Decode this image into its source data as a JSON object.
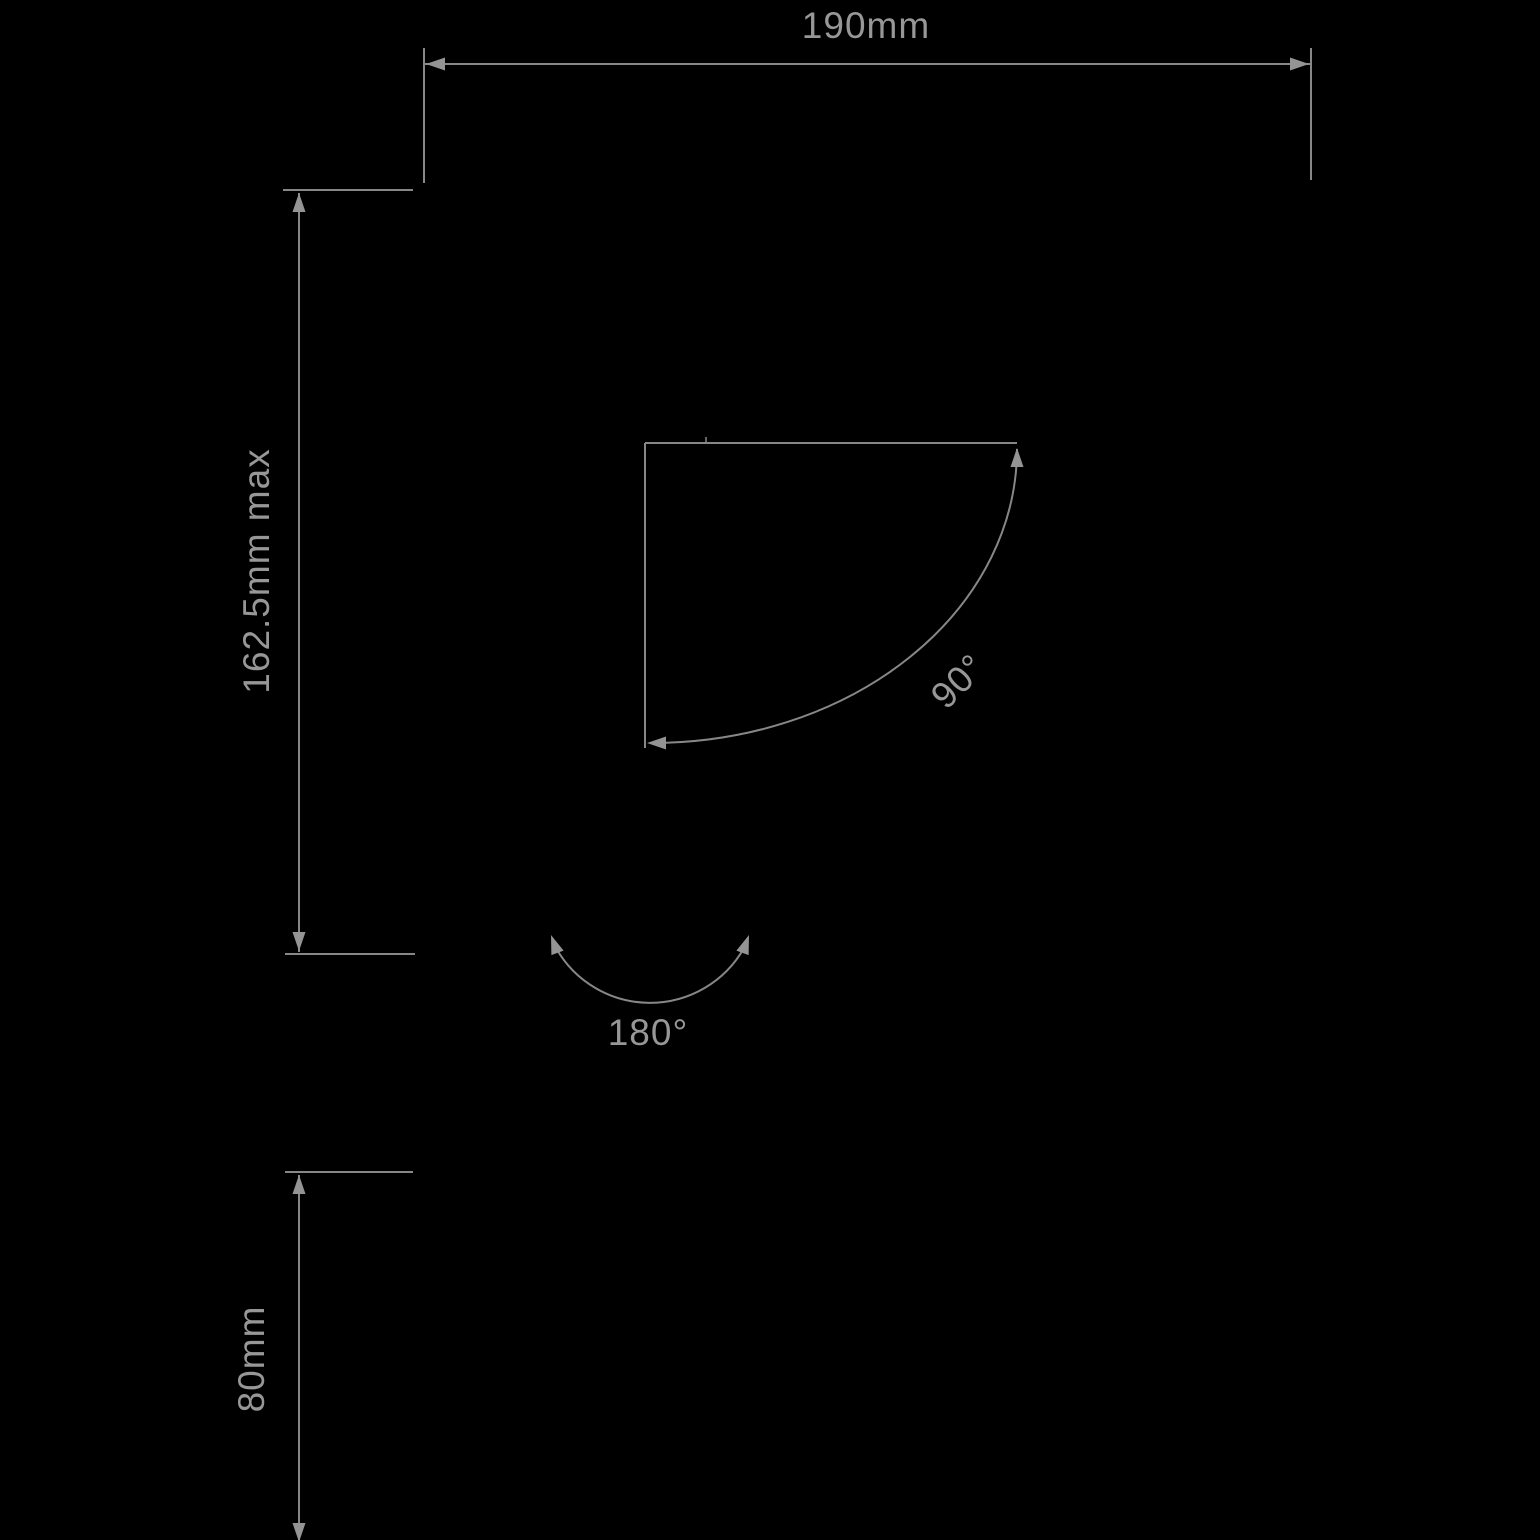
{
  "drawing": {
    "type": "technical-dimension-drawing",
    "colors": {
      "background": "#000000",
      "line": "#878787",
      "arrow": "#949494",
      "text": "#979797"
    },
    "dimension_labels": {
      "top_width": "190mm",
      "left_height": "162.5mm max",
      "tilt_angle": "90°",
      "swivel_angle": "180°",
      "bottom_height": "80mm"
    }
  }
}
